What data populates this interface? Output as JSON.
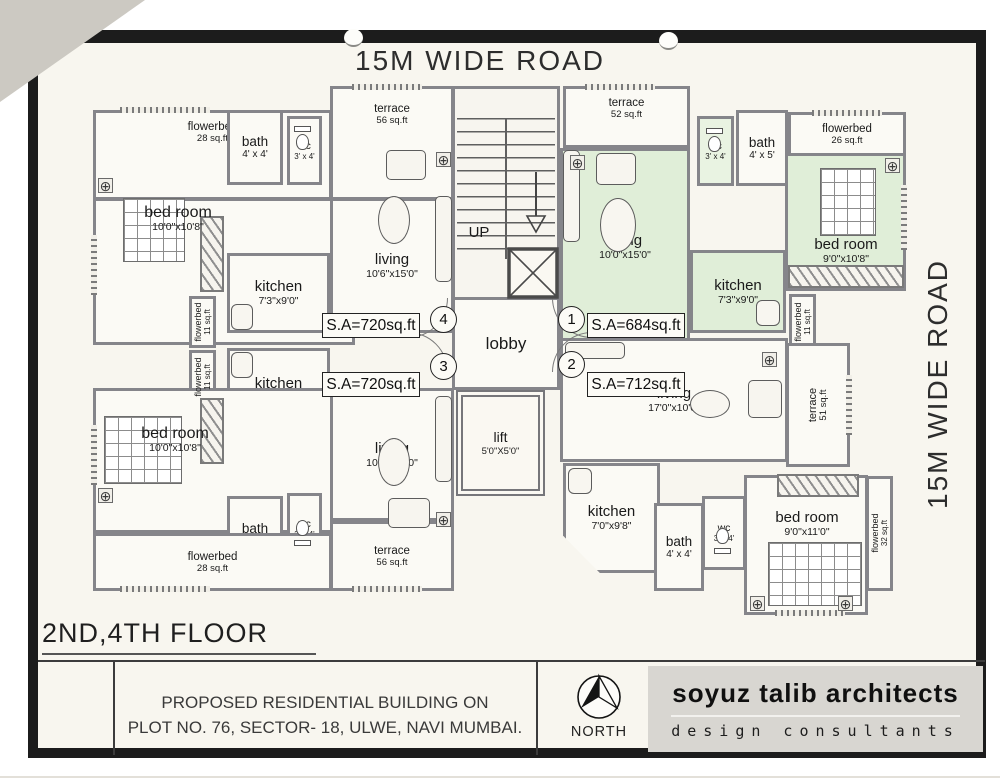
{
  "roads": {
    "top": "15M WIDE ROAD",
    "right": "15M WIDE ROAD"
  },
  "icons": {
    "column_marker": "⊕"
  },
  "core": {
    "up": "UP",
    "lobby": "lobby",
    "lift": {
      "name": "lift",
      "dims": "5'0\"X5'0\""
    }
  },
  "flats": {
    "f4": {
      "number": "4",
      "area": "S.A=720sq.ft",
      "flowerbed_top": {
        "name": "flowerbed",
        "dims": "28 sq.ft"
      },
      "bath": {
        "name": "bath",
        "dims": "4' x 4'"
      },
      "wc": {
        "name": "wc",
        "dims": "3' x 4'"
      },
      "terrace": {
        "name": "terrace",
        "dims": "56 sq.ft"
      },
      "bedroom": {
        "name": "bed room",
        "dims": "10'0\"x10'8\""
      },
      "living": {
        "name": "living",
        "dims": "10'6\"x15'0\""
      },
      "kitchen": {
        "name": "kitchen",
        "dims": "7'3\"x9'0\""
      },
      "flowerbed_side": {
        "name": "flowerbed",
        "dims": "11 sq.ft"
      }
    },
    "f1": {
      "number": "1",
      "area": "S.A=684sq.ft",
      "terrace": {
        "name": "terrace",
        "dims": "52 sq.ft"
      },
      "wc": {
        "name": "wc",
        "dims": "3' x 4'"
      },
      "bath": {
        "name": "bath",
        "dims": "4' x 5'"
      },
      "flowerbed_top": {
        "name": "flowerbed",
        "dims": "26 sq.ft"
      },
      "living": {
        "name": "living",
        "dims": "10'0\"x15'0\""
      },
      "bedroom": {
        "name": "bed room",
        "dims": "9'0\"x10'8\""
      },
      "kitchen": {
        "name": "kitchen",
        "dims": "7'3\"x9'0\""
      },
      "flowerbed_side": {
        "name": "flowerbed",
        "dims": "11 sq.ft"
      }
    },
    "f3": {
      "number": "3",
      "area": "S.A=720sq.ft",
      "kitchen": {
        "name": "kitchen",
        "dims": "7'3\"x9'0\""
      },
      "flowerbed_side": {
        "name": "flowerbed",
        "dims": "11 sq.ft"
      },
      "bedroom": {
        "name": "bed room",
        "dims": "10'0\"x10'8\""
      },
      "living": {
        "name": "living",
        "dims": "10'6\"x15'0\""
      },
      "bath": {
        "name": "bath",
        "dims": "4' x 4'"
      },
      "wc": {
        "name": "wc",
        "dims": "3' x 4'"
      },
      "flowerbed_bottom": {
        "name": "flowerbed",
        "dims": "28 sq.ft"
      },
      "terrace": {
        "name": "terrace",
        "dims": "56 sq.ft"
      }
    },
    "f2": {
      "number": "2",
      "area": "S.A=712sq.ft",
      "living": {
        "name": "living",
        "dims": "17'0\"x10'0\""
      },
      "terrace": {
        "name": "terrace",
        "dims": "51 sq.ft"
      },
      "kitchen": {
        "name": "kitchen",
        "dims": "7'0\"x9'8\""
      },
      "bath": {
        "name": "bath",
        "dims": "4' x 4'"
      },
      "wc": {
        "name": "wc",
        "dims": "3' x 4'"
      },
      "bedroom": {
        "name": "bed room",
        "dims": "9'0\"x11'0\""
      },
      "flowerbed_side": {
        "name": "flowerbed",
        "dims": "32 sq.ft"
      }
    }
  },
  "footer": {
    "floor_label": "2ND,4TH FLOOR",
    "project_line1": "PROPOSED RESIDENTIAL BUILDING ON",
    "project_line2": "PLOT NO. 76, SECTOR- 18, ULWE, NAVI MUMBAI.",
    "north_label": "NORTH",
    "firm_name": "soyuz talib architects",
    "firm_subtitle": "design consultants"
  },
  "colors": {
    "flat1_fill": "#e0eed8",
    "paper": "#f8f6ef",
    "frame": "#1c1c1c"
  }
}
